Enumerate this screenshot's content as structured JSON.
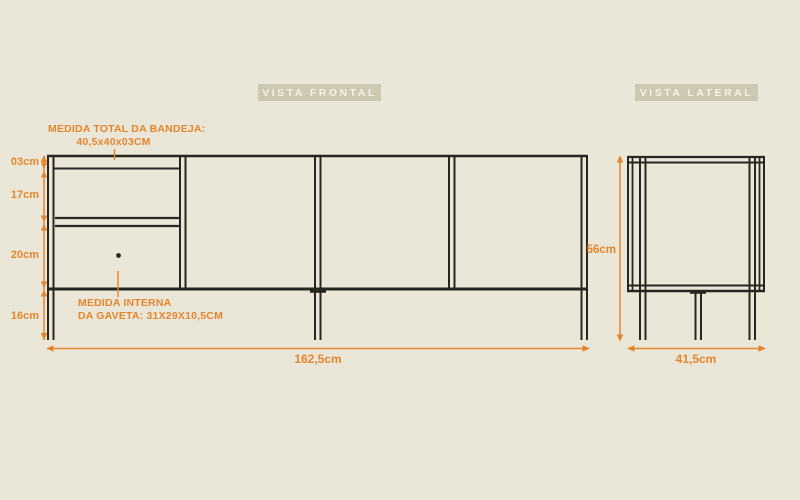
{
  "colors": {
    "background": "#eae7d9",
    "line": "#28271f",
    "accent": "#e5862d",
    "badge_background": "#cdc8b4",
    "badge_text": "#f5f2e3"
  },
  "front_view": {
    "badge_label": "VISTA FRONTAL",
    "tray_note_line1": "MEDIDA TOTAL DA BANDEJA:",
    "tray_note_line2": "40,5x40x03CM",
    "drawer_note_line1": "MEDIDA INTERNA",
    "drawer_note_line2": "DA GAVETA: 31X29X10,5CM",
    "height_segments": [
      "03cm",
      "17cm",
      "20cm",
      "16cm"
    ],
    "total_width_label": "162,5cm"
  },
  "side_view": {
    "badge_label": "VISTA LATERAL",
    "height_label": "56cm",
    "depth_label": "41,5cm"
  }
}
